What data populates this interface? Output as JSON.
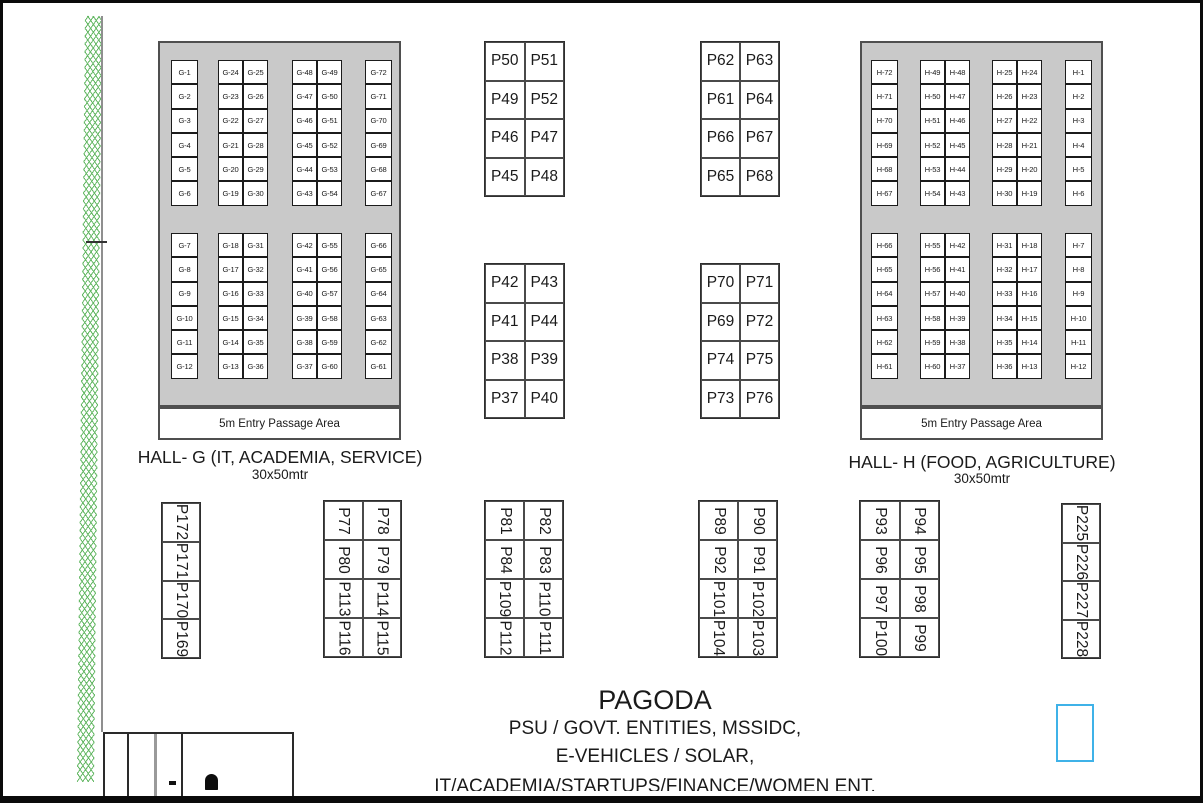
{
  "halls": [
    {
      "name": "hall-g",
      "title": "HALL- G (IT, ACADEMIA, SERVICE)",
      "size": "30x50mtr",
      "passage": "5m Entry Passage Area",
      "top": [
        [
          "G-1",
          "G-2",
          "G-3",
          "G-4",
          "G-5",
          "G-6"
        ],
        [
          [
            "G-24",
            "G-25"
          ],
          [
            "G-23",
            "G-26"
          ],
          [
            "G-22",
            "G-27"
          ],
          [
            "G-21",
            "G-28"
          ],
          [
            "G-20",
            "G-29"
          ],
          [
            "G-19",
            "G-30"
          ]
        ],
        [
          [
            "G-48",
            "G-49"
          ],
          [
            "G-47",
            "G-50"
          ],
          [
            "G-46",
            "G-51"
          ],
          [
            "G-45",
            "G-52"
          ],
          [
            "G-44",
            "G-53"
          ],
          [
            "G-43",
            "G-54"
          ]
        ],
        [
          "G-72",
          "G-71",
          "G-70",
          "G-69",
          "G-68",
          "G-67"
        ]
      ],
      "bottom": [
        [
          "G-7",
          "G-8",
          "G-9",
          "G-10",
          "G-11",
          "G-12"
        ],
        [
          [
            "G-18",
            "G-31"
          ],
          [
            "G-17",
            "G-32"
          ],
          [
            "G-16",
            "G-33"
          ],
          [
            "G-15",
            "G-34"
          ],
          [
            "G-14",
            "G-35"
          ],
          [
            "G-13",
            "G-36"
          ]
        ],
        [
          [
            "G-42",
            "G-55"
          ],
          [
            "G-41",
            "G-56"
          ],
          [
            "G-40",
            "G-57"
          ],
          [
            "G-39",
            "G-58"
          ],
          [
            "G-38",
            "G-59"
          ],
          [
            "G-37",
            "G-60"
          ]
        ],
        [
          "G-66",
          "G-65",
          "G-64",
          "G-63",
          "G-62",
          "G-61"
        ]
      ]
    },
    {
      "name": "hall-h",
      "title": "HALL- H (FOOD, AGRICULTURE)",
      "size": "30x50mtr",
      "passage": "5m Entry Passage Area",
      "top": [
        [
          "H-72",
          "H-71",
          "H-70",
          "H-69",
          "H-68",
          "H-67"
        ],
        [
          [
            "H-49",
            "H-48"
          ],
          [
            "H-50",
            "H-47"
          ],
          [
            "H-51",
            "H-46"
          ],
          [
            "H-52",
            "H-45"
          ],
          [
            "H-53",
            "H-44"
          ],
          [
            "H-54",
            "H-43"
          ]
        ],
        [
          [
            "H-25",
            "H-24"
          ],
          [
            "H-26",
            "H-23"
          ],
          [
            "H-27",
            "H-22"
          ],
          [
            "H-28",
            "H-21"
          ],
          [
            "H-29",
            "H-20"
          ],
          [
            "H-30",
            "H-19"
          ]
        ],
        [
          "H-1",
          "H-2",
          "H-3",
          "H-4",
          "H-5",
          "H-6"
        ]
      ],
      "bottom": [
        [
          "H-66",
          "H-65",
          "H-64",
          "H-63",
          "H-62",
          "H-61"
        ],
        [
          [
            "H-55",
            "H-42"
          ],
          [
            "H-56",
            "H-41"
          ],
          [
            "H-57",
            "H-40"
          ],
          [
            "H-58",
            "H-39"
          ],
          [
            "H-59",
            "H-38"
          ],
          [
            "H-60",
            "H-37"
          ]
        ],
        [
          [
            "H-31",
            "H-18"
          ],
          [
            "H-32",
            "H-17"
          ],
          [
            "H-33",
            "H-16"
          ],
          [
            "H-34",
            "H-15"
          ],
          [
            "H-35",
            "H-14"
          ],
          [
            "H-36",
            "H-13"
          ]
        ],
        [
          "H-7",
          "H-8",
          "H-9",
          "H-10",
          "H-11",
          "H-12"
        ]
      ]
    }
  ],
  "mid_blocks": [
    [
      [
        "P50",
        "P51"
      ],
      [
        "P49",
        "P52"
      ],
      [
        "P46",
        "P47"
      ],
      [
        "P45",
        "P48"
      ]
    ],
    [
      [
        "P62",
        "P63"
      ],
      [
        "P61",
        "P64"
      ],
      [
        "P66",
        "P67"
      ],
      [
        "P65",
        "P68"
      ]
    ],
    [
      [
        "P42",
        "P43"
      ],
      [
        "P41",
        "P44"
      ],
      [
        "P38",
        "P39"
      ],
      [
        "P37",
        "P40"
      ]
    ],
    [
      [
        "P70",
        "P71"
      ],
      [
        "P69",
        "P72"
      ],
      [
        "P74",
        "P75"
      ],
      [
        "P73",
        "P76"
      ]
    ]
  ],
  "bottom_blocks": [
    [
      "P172",
      "P171",
      "P170",
      "P169"
    ],
    [
      [
        "P77",
        "P78"
      ],
      [
        "P80",
        "P79"
      ],
      [
        "P113",
        "P114"
      ],
      [
        "P116",
        "P115"
      ]
    ],
    [
      [
        "P81",
        "P82"
      ],
      [
        "P84",
        "P83"
      ],
      [
        "P109",
        "P110"
      ],
      [
        "P112",
        "P111"
      ]
    ],
    [
      [
        "P89",
        "P90"
      ],
      [
        "P92",
        "P91"
      ],
      [
        "P101",
        "P102"
      ],
      [
        "P104",
        "P103"
      ]
    ],
    [
      [
        "P93",
        "P94"
      ],
      [
        "P96",
        "P95"
      ],
      [
        "P97",
        "P98"
      ],
      [
        "P100",
        "P99"
      ]
    ],
    [
      "P225",
      "P226",
      "P227",
      "P228"
    ]
  ],
  "pagoda": {
    "title": "PAGODA",
    "line1": "PSU / GOVT. ENTITIES, MSSIDC,",
    "line2": "E-VEHICLES / SOLAR,",
    "line3": "IT/ACADEMIA/STARTUPS/FINANCE/WOMEN ENT."
  },
  "colors": {
    "hall_fill": "#c9c9c9",
    "hatch_green": "#55b155",
    "marker_blue": "#3fb2e8"
  }
}
